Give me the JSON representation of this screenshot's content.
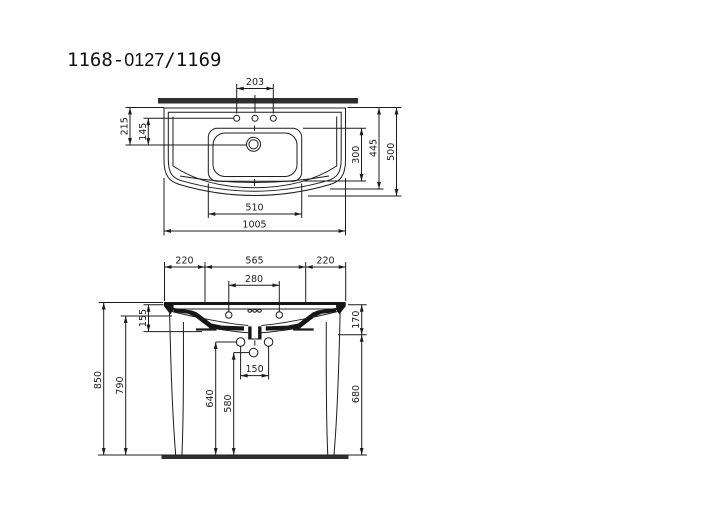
{
  "title": {
    "part1": "1168-",
    "part2": "0127",
    "part3": "/1169",
    "full": "1168-0127/1169"
  },
  "colors": {
    "line": "#1c1c1c",
    "section_fill": "#161616",
    "wall_floor_band": "#2f2f2f",
    "background": "#ffffff"
  },
  "top_view": {
    "dims": {
      "faucet_hole_spacing": "203",
      "rear_to_drain": "215",
      "faucet_to_drain": "145",
      "bowl_depth": "300",
      "body_depth": "445",
      "overall_depth": "500",
      "bowl_width": "510",
      "overall_width": "1005"
    }
  },
  "front_view": {
    "dims": {
      "left_span": "220",
      "center_span": "565",
      "right_span": "220",
      "rear_hole_spacing": "280",
      "rim_drop": "155",
      "apron_height": "170",
      "overall_height": "850",
      "underside_height": "790",
      "upper_hole_height": "640",
      "lower_hole_height": "580",
      "bracket_hole_spacing": "150",
      "leg_height": "680"
    }
  }
}
